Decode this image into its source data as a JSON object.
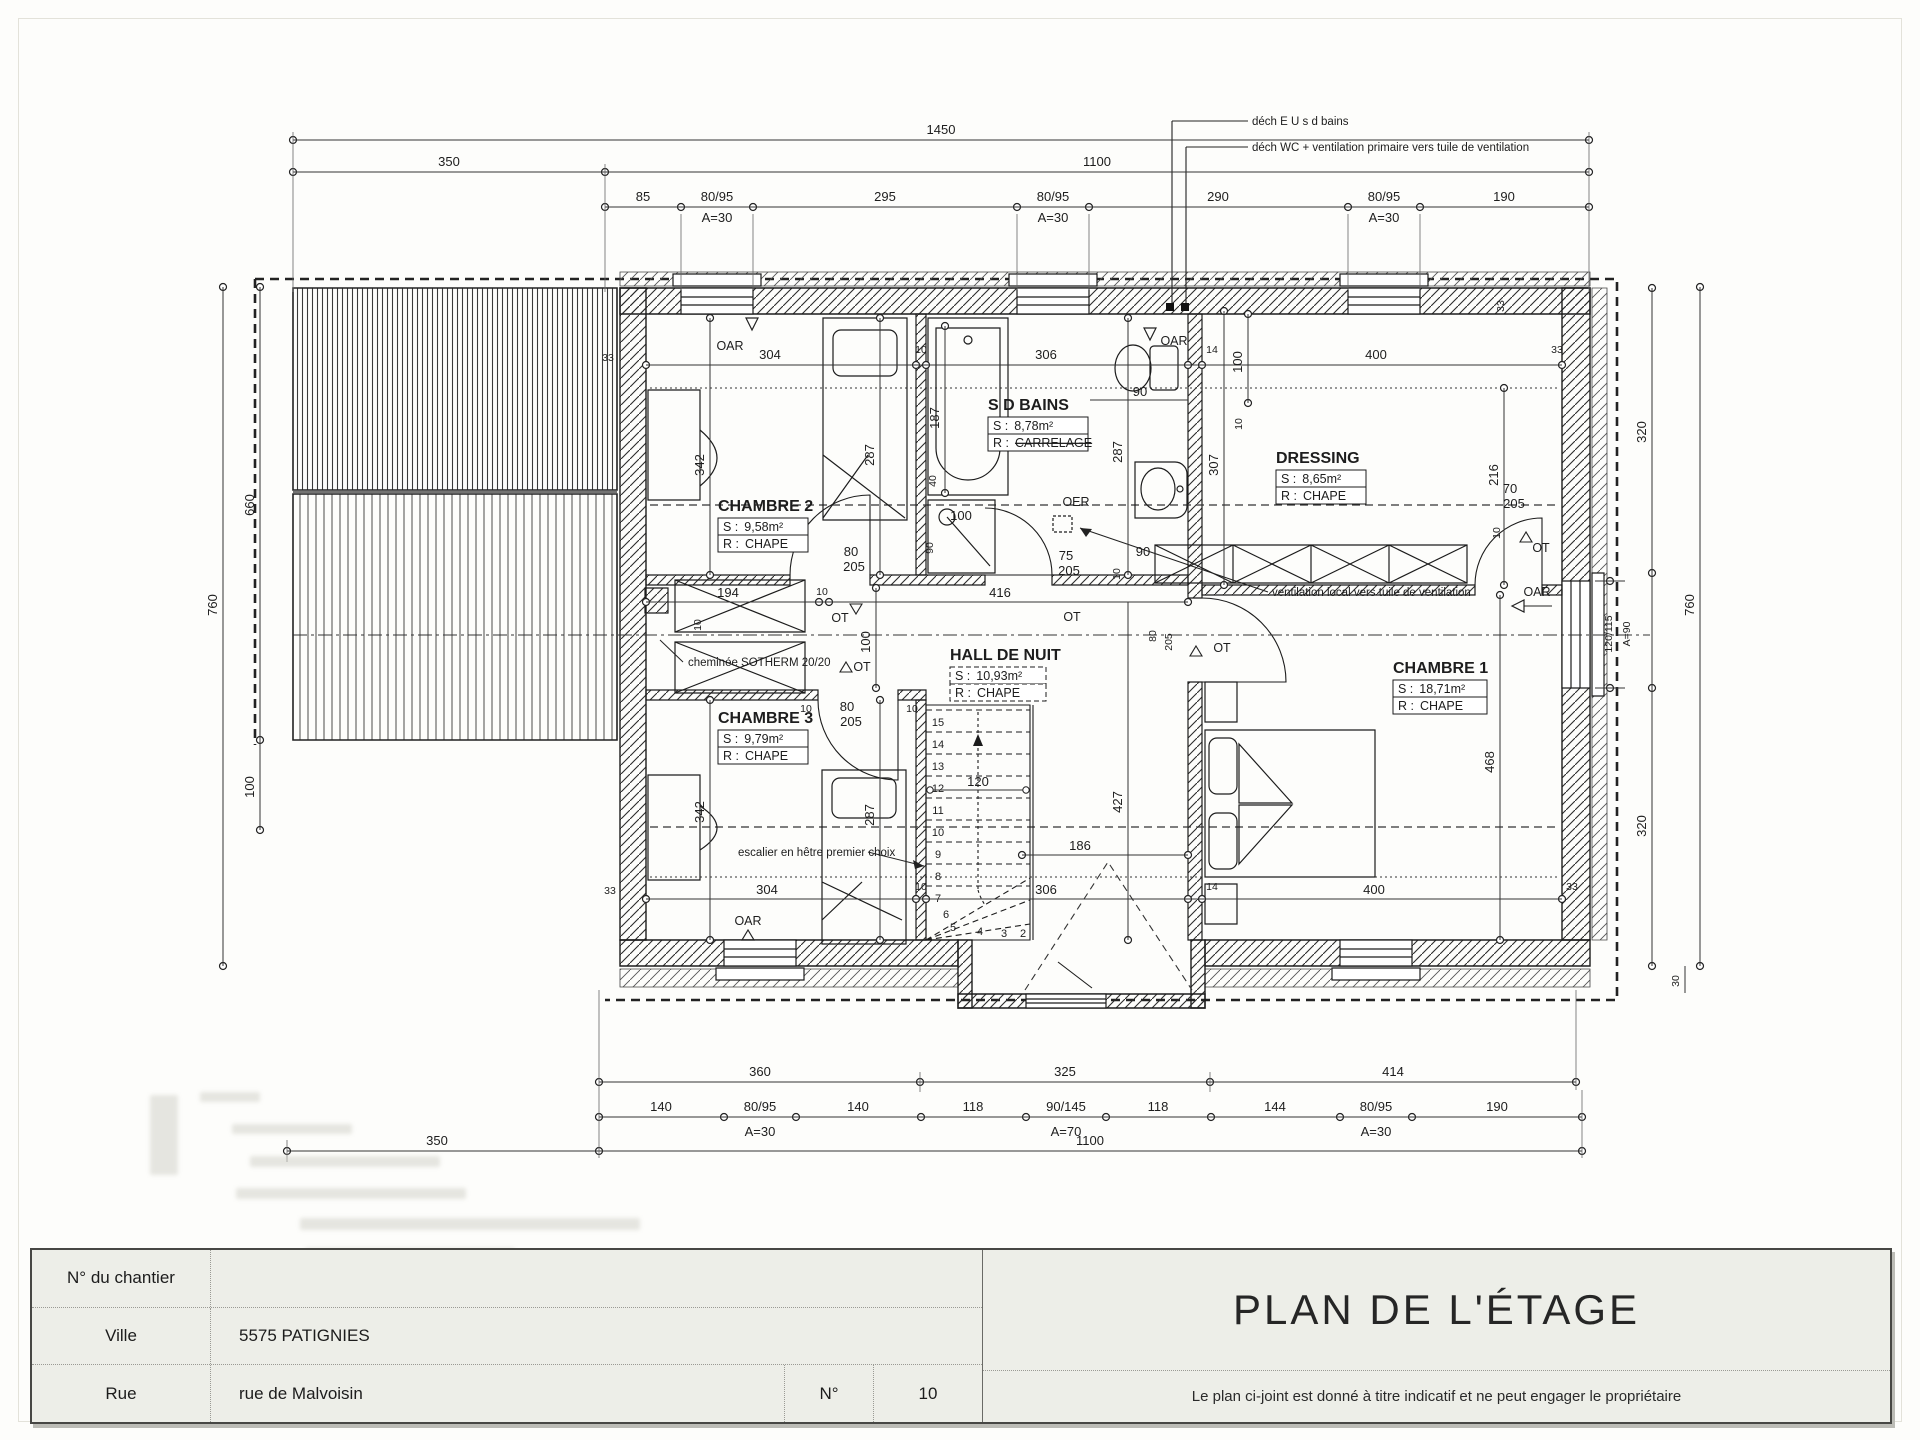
{
  "annotations": {
    "dech_eu": "déch E U s d bains",
    "dech_wc": "déch WC + ventilation primaire vers tuile de ventilation",
    "vent_local": "ventilation local vers tuile de ventilation",
    "cheminee": "cheminée SOTHERM 20/20",
    "escalier": "escalier en hêtre premier choix"
  },
  "doors": {
    "oar": "OAR",
    "ot": "OT",
    "oer": "OER"
  },
  "rooms": {
    "ch1": {
      "name": "CHAMBRE 1",
      "s_label": "S :",
      "s_value": "18,71m²",
      "r_label": "R :",
      "r_value": "CHAPE"
    },
    "ch2": {
      "name": "CHAMBRE 2",
      "s_label": "S :",
      "s_value": "9,58m²",
      "r_label": "R :",
      "r_value": "CHAPE"
    },
    "ch3": {
      "name": "CHAMBRE 3",
      "s_label": "S :",
      "s_value": "9,79m²",
      "r_label": "R :",
      "r_value": "CHAPE"
    },
    "sdb": {
      "name": "S D BAINS",
      "s_label": "S :",
      "s_value": "8,78m²",
      "r_label": "R :",
      "r_value": "CARRELAGE"
    },
    "dressing": {
      "name": "DRESSING",
      "s_label": "S :",
      "s_value": "8,65m²",
      "r_label": "R :",
      "r_value": "CHAPE"
    },
    "hall": {
      "name": "HALL DE NUIT",
      "s_label": "S :",
      "s_value": "10,93m²",
      "r_label": "R :",
      "r_value": "CHAPE"
    }
  },
  "dims": {
    "t1450": "1450",
    "t350": "350",
    "t1100": "1100",
    "n85": "85",
    "n8095": "80/95",
    "a30": "A=30",
    "n295": "295",
    "n290": "290",
    "n190": "190",
    "b360": "360",
    "b325": "325",
    "b414": "414",
    "n140": "140",
    "n118": "118",
    "n90145": "90/145",
    "a70": "A=70",
    "n144": "144",
    "b350": "350",
    "b1100": "1100",
    "v760": "760",
    "v660": "660",
    "v100": "100",
    "v320": "320",
    "v120115": "120/115",
    "a90": "A=90",
    "v30": "30",
    "n33": "33",
    "n304": "304",
    "n10": "10",
    "n306": "306",
    "n14": "14",
    "n400": "400",
    "n342": "342",
    "n287": "287",
    "n187": "187",
    "n40": "40",
    "n90": "90",
    "n100": "100",
    "n194": "194",
    "n216": "216",
    "n307": "307",
    "n416": "416",
    "n427": "427",
    "n468": "468",
    "n186": "186",
    "n120": "120",
    "n80": "80",
    "n205": "205",
    "n75": "75",
    "n70": "70"
  },
  "steps": [
    "15",
    "14",
    "13",
    "12",
    "11",
    "10",
    "9",
    "8",
    "7",
    "6",
    "5",
    "4",
    "3",
    "2"
  ],
  "title_block": {
    "rows": [
      {
        "label": "N° du chantier",
        "value": ""
      },
      {
        "label": "Ville",
        "value": "5575 PATIGNIES"
      },
      {
        "label": "Rue",
        "value": "rue de Malvoisin",
        "n_label": "N°",
        "n_value": "10"
      }
    ],
    "title": "PLAN DE L'ÉTAGE",
    "note": "Le plan ci-joint est donné à titre indicatif et ne peut engager le propriétaire"
  }
}
